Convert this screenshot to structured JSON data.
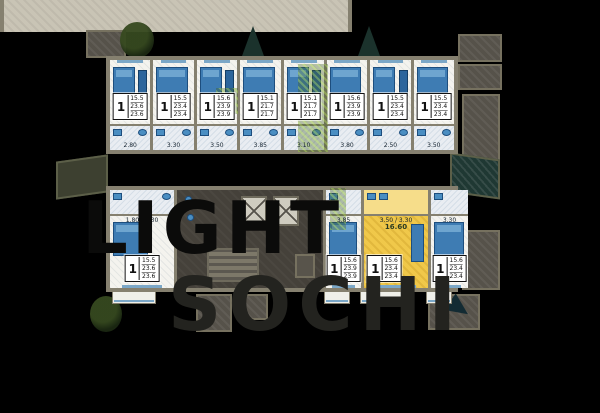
{
  "watermark": {
    "line1": "LIGHT",
    "line2": "SOCHI"
  },
  "units_top": [
    {
      "num": "1",
      "a1": "15.5",
      "a2": "23.6",
      "a3": "23.6",
      "dim": "2.80"
    },
    {
      "num": "1",
      "a1": "15.5",
      "a2": "23.4",
      "a3": "23.4",
      "dim": "3.30"
    },
    {
      "num": "1",
      "a1": "15.6",
      "a2": "23.9",
      "a3": "23.9",
      "dim": "3.50"
    },
    {
      "num": "1",
      "a1": "15.1",
      "a2": "21.7",
      "a3": "21.7",
      "dim": "3.85"
    },
    {
      "num": "1",
      "a1": "15.1",
      "a2": "21.7",
      "a3": "21.7",
      "dim": "3.10"
    },
    {
      "num": "1",
      "a1": "15.6",
      "a2": "23.9",
      "a3": "23.9",
      "dim": "3.80"
    },
    {
      "num": "1",
      "a1": "15.5",
      "a2": "23.4",
      "a3": "23.4",
      "dim": "2.50"
    },
    {
      "num": "1",
      "a1": "15.5",
      "a2": "23.4",
      "a3": "23.4",
      "dim": "3.50"
    }
  ],
  "unit_bottom_left": {
    "num": "1",
    "a1": "15.5",
    "a2": "23.6",
    "a3": "23.6",
    "dim": "1.80 / 3.30"
  },
  "units_bottom_right": [
    {
      "num": "1",
      "a1": "15.6",
      "a2": "23.9",
      "a3": "23.9",
      "dim": "3.85"
    },
    {
      "num": "1",
      "a1": "15.6",
      "a2": "23.4",
      "a3": "23.4",
      "dim": "3.50 / 3.30",
      "room_area": "16.60",
      "highlighted": true
    },
    {
      "num": "1",
      "a1": "15.6",
      "a2": "23.4",
      "a3": "23.4",
      "dim": "3.30"
    }
  ],
  "colors": {
    "background": "#000000",
    "walls": "#85806f",
    "unit_floor": "#f4f3ee",
    "furniture_blue": "#3e7cb3",
    "highlight_yellow": "#f0c84a",
    "watermark_dark": "#0b0b0a",
    "watermark_gray": "#23231f"
  }
}
